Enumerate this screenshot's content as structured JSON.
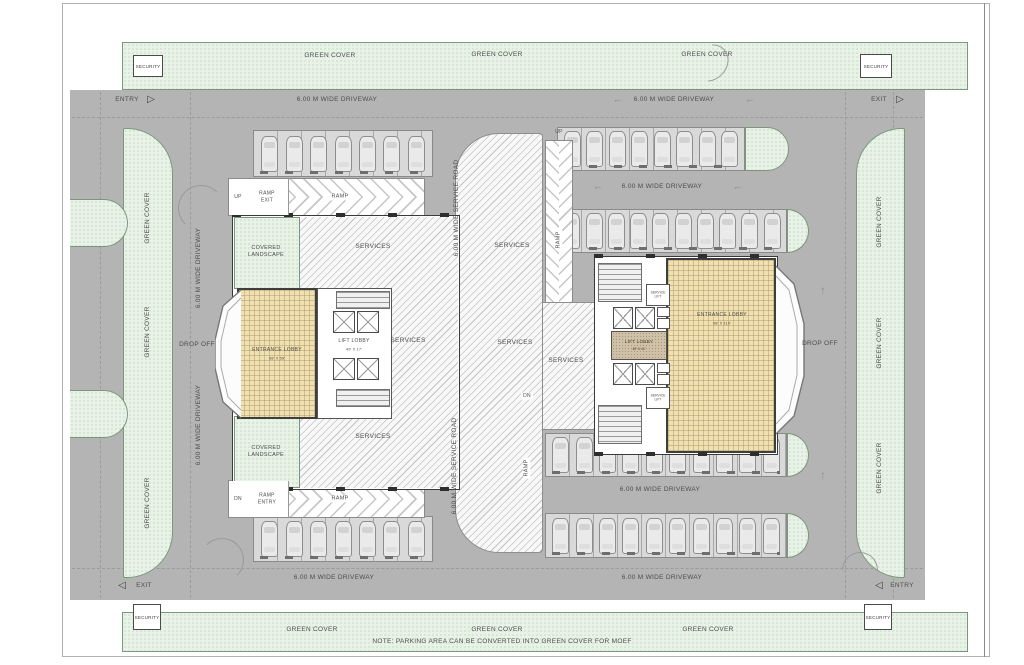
{
  "note": "NOTE: PARKING AREA CAN BE CONVERTED INTO GREEN COVER FOR MOEF",
  "labels": {
    "green_cover": "GREEN COVER",
    "security": "SECURITY",
    "entry": "ENTRY",
    "exit": "EXIT",
    "driveway": "6.00 M WIDE DRIVEWAY",
    "service_road": "6.00 M WIDE SERVICE ROAD",
    "services": "SERVICES",
    "ramp": "RAMP",
    "ramp_exit": "RAMP EXIT",
    "ramp_entry": "RAMP ENTRY",
    "up": "UP",
    "dn": "DN",
    "drop_off": "DROP OFF",
    "covered_landscape": "COVERED LANDSCAPE",
    "entrance_lobby": "ENTRANCE LOBBY",
    "lift_lobby": "LIFT LOBBY",
    "service_lift": "SERVICE LIFT"
  },
  "dims": {
    "entrance_lobby_left": "98' X 59'",
    "lift_lobby_left": "49' X 17'",
    "entrance_lobby_right": "98' X 110'",
    "lift_lobby_right": "49' X 41'"
  },
  "glyphs": {
    "tri_right": "▷",
    "tri_left": "◁",
    "arrow_left": "←",
    "arrow_up": "↑"
  },
  "colors": {
    "site_gray": "#b4b4b4",
    "green_fill": "#e8f2e6",
    "tan_fill": "#efe1b3",
    "lobby_brown": "#cfc0a8"
  },
  "parking": {
    "rows": [
      {
        "id": "top-left",
        "cars": 7
      },
      {
        "id": "top-right-a",
        "cars": 8
      },
      {
        "id": "top-right-b",
        "cars": 10
      },
      {
        "id": "bottom-right-c",
        "cars": 10
      },
      {
        "id": "bottom-right-d",
        "cars": 10
      },
      {
        "id": "bottom-left",
        "cars": 7
      }
    ]
  }
}
